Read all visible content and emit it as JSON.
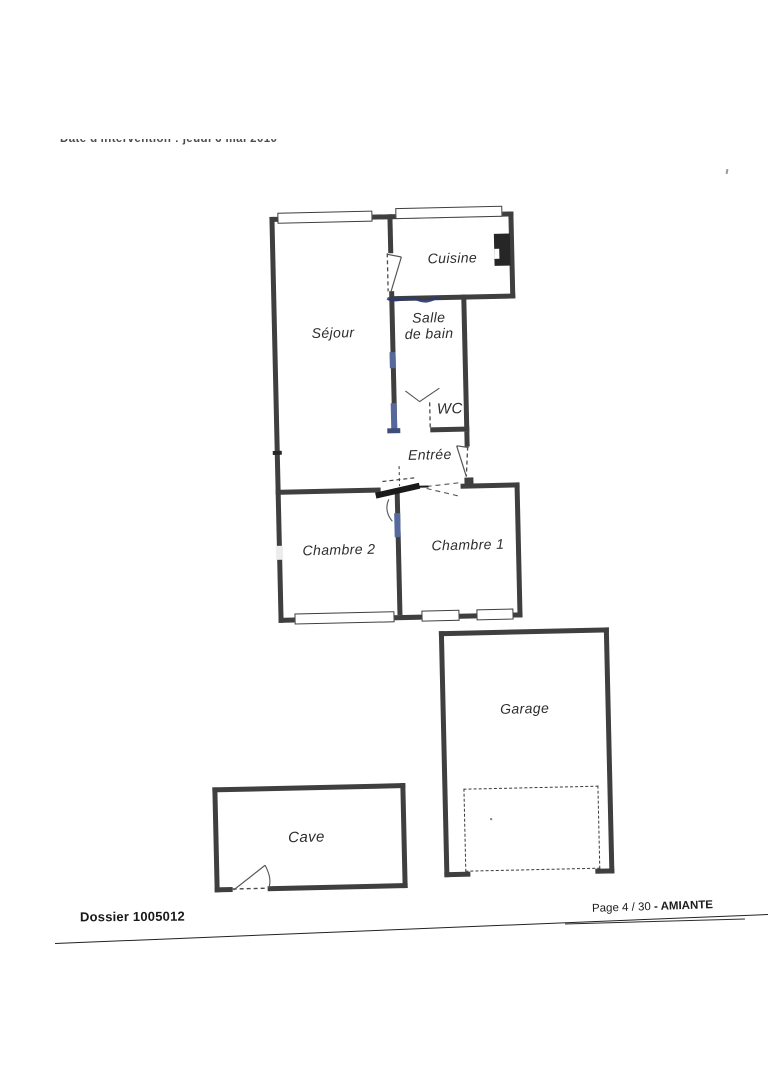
{
  "document": {
    "date_line": "Date d'intervention : jeudi 6 mai 2010",
    "footer": {
      "dossier": "Dossier 1005012",
      "page": "Page 4 / 30",
      "report": "- AMIANTE"
    }
  },
  "floorplan": {
    "rooms": [
      {
        "id": "sejour",
        "label": "Séjour"
      },
      {
        "id": "cuisine",
        "label": "Cuisine"
      },
      {
        "id": "salle-de-bain",
        "label": "Salle de bain"
      },
      {
        "id": "wc",
        "label": "WC"
      },
      {
        "id": "entree",
        "label": "Entrée"
      },
      {
        "id": "chambre-2",
        "label": "Chambre 2"
      },
      {
        "id": "chambre-1",
        "label": "Chambre 1"
      },
      {
        "id": "garage",
        "label": "Garage"
      },
      {
        "id": "cave",
        "label": "Cave"
      }
    ],
    "colors": {
      "wall": "#3f3f3f",
      "door_mark_blue": "#55699c",
      "ink": "#2d2d2d"
    }
  }
}
